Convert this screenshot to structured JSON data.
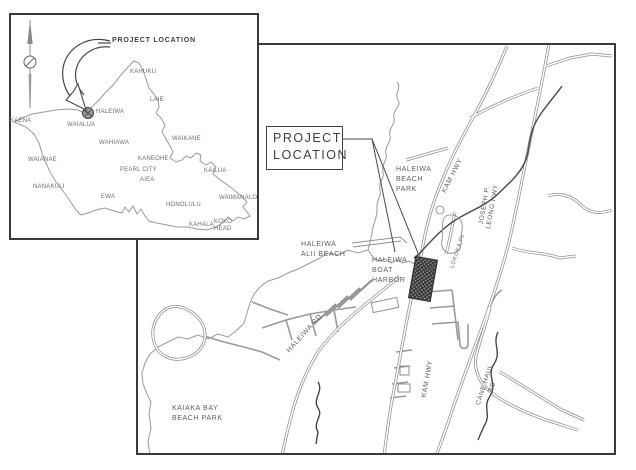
{
  "inset": {
    "project_location": "PROJECT LOCATION",
    "places": {
      "kaena": "KAENA",
      "haleiwa": "HALEIWA",
      "waialua": "WAIALUA",
      "kahuku": "KAHUKU",
      "laie": "LAIE",
      "wahiawa": "WAHIAWA",
      "waikane": "WAIKANE",
      "kaneohe": "KANEOHE",
      "pearl_city": "PEARL CITY",
      "aiea": "AIEA",
      "kailua": "KAILUA",
      "waianae": "WAIANAE",
      "nanakuli": "NANAKULI",
      "ewa": "EWA",
      "honolulu": "HONOLULU",
      "kahala": "KAHALA",
      "waimanalo": "WAIMANALO",
      "koko_head": "KOKO\nHEAD"
    }
  },
  "main": {
    "project_location_box": "PROJECT\nLOCATION",
    "areas": {
      "haleiwa_beach_park": "HALEIWA\nBEACH\nPARK",
      "haleiwa_alii_beach": "HALEIWA\nALII BEACH",
      "haleiwa_boat_harbor": "HALEIWA\nBOAT\nHARBOR",
      "kaiaka_bay_beach_park": "KAIAKA BAY\nBEACH PARK"
    },
    "roads": {
      "kam_hwy_north": "KAM HWY",
      "kam_hwy_south": "KAM HWY",
      "joseph_p_leong_hwy": "JOSEPH P.\nLEONG HWY",
      "haleiwa_rd": "HALEIWA RD",
      "cane_haul_rd": "CANE HAUL\nRD",
      "lokoea_pl": "LOKOEA PL"
    }
  },
  "colors": {
    "frame": "#3a3a3a",
    "map_line": "#9a9a9a",
    "stream": "#474747",
    "label": "#5e5e5e",
    "site_fill": "#8a8a8a",
    "site_hatch": "#2e2e2e"
  }
}
